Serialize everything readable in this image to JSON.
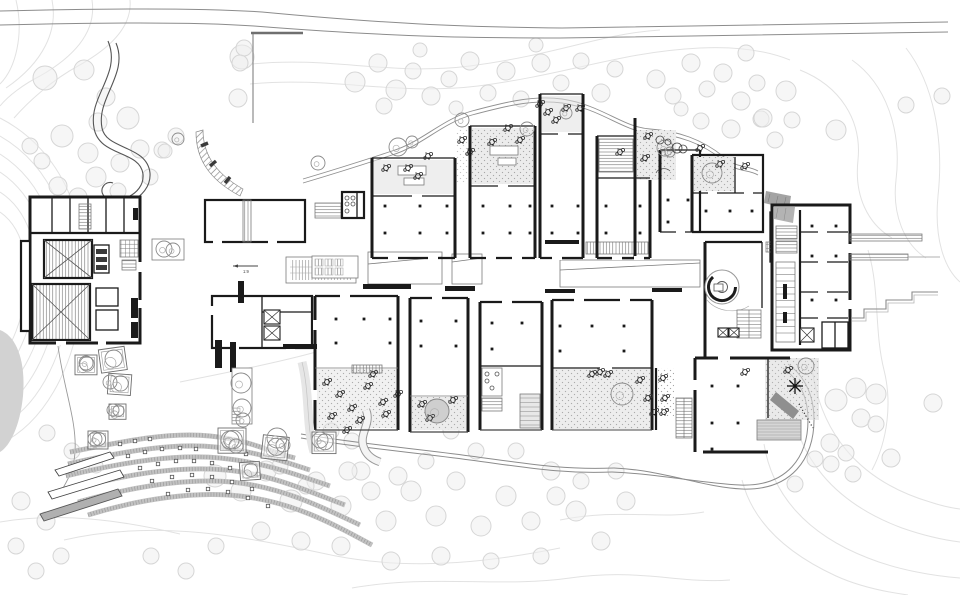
{
  "meta": {
    "drawing_type": "architectural site plan",
    "description": "Black-and-white campus site plan on a contoured, tree-covered hillside with curved terraced seating at lower left"
  },
  "palette": {
    "background": "#ffffff",
    "wall": "#1a1a1a",
    "wall_medium": "#4a4a4a",
    "outline_light": "#7a7a7a",
    "contour": "#e2e2e2",
    "tree_stroke": "#d6d6d6",
    "tree_fill": "#efefef",
    "paving_gray": "#e0e0e0",
    "stipple": "#9c9c9c",
    "terrace_band": "#c2c2c2",
    "terrace_tick": "#7d7d7d",
    "road": "#8c8c8c",
    "dark_gray_fill": "#9a9a9a",
    "hill_fill": "#d2d2d2"
  },
  "annotations": {
    "ramp_label": "1:9"
  },
  "site": {
    "hill_blob": "M0,330 C16,336 26,360 23,396 C20,426 10,446 0,452 Z",
    "contours": [
      "M0,118 C62,150 92,220 82,300 C74,372 42,424 0,444",
      "M0,136 C52,166 78,228 70,300 C62,364 34,410 0,426",
      "M0,154 C44,182 64,236 58,298 C52,352 26,396 0,410",
      "M0,172 C36,196 52,242 47,296 C42,342 20,382 0,394",
      "M0,192 C28,210 40,248 36,292 C32,330 14,366 0,376",
      "M0,212 C20,226 28,252 26,288 C24,318 10,350 0,358",
      "M16,0 C24,34 16,68 0,84",
      "M52,0 C58,30 44,62 6,88",
      "M92,0 C96,26 82,52 40,76 C24,84 8,96 0,106",
      "M130,0 C132,22 118,44 78,66 C52,80 28,102 14,118",
      "M252,64 C330,56 390,76 470,66 C560,54 600,34 660,30",
      "M250,84 C330,76 396,96 478,86 C570,74 620,52 700,48 C740,46 770,52 790,60",
      "M800,70 C840,86 862,120 858,160 C854,196 868,224 892,238",
      "M852,60 C886,84 902,130 896,180 C892,214 904,244 926,258",
      "M906,48 C934,84 944,140 938,196 C934,238 944,268 960,282",
      "M868,250 C880,290 874,330 884,370 C892,402 888,440 872,470",
      "M812,368 C820,430 856,480 930,502 C942,506 952,508 960,509",
      "M790,400 C798,456 832,502 902,528 C922,535 944,540 960,542",
      "M764,444 C772,494 806,534 868,558 C898,570 934,576 960,578",
      "M742,480 C752,520 784,552 836,576 C858,586 886,592 908,595",
      "M64,540 C160,518 250,538 336,556 C420,572 500,560 560,548",
      "M0,522 C60,512 120,520 180,534",
      "M352,588 C430,574 500,588 570,578 C640,568 680,584 730,580",
      "M560,520 C620,508 660,520 704,512",
      "M180,382 C230,372 280,362 316,352"
    ],
    "roads": [
      {
        "d": "M0,11 C120,8 205,8 262,12 C400,25 472,27 562,28 L948,22",
        "w": 1,
        "c": "#8c8c8c"
      },
      {
        "d": "M0,25 C118,22 198,22 254,26 C394,37 470,38 560,38 L948,32",
        "w": 1,
        "c": "#8c8c8c"
      },
      {
        "d": "M253,34 L253,123",
        "w": 1.2,
        "c": "#8c8c8c"
      },
      {
        "d": "M251,33 L303,33",
        "w": 2.4,
        "c": "#6f6f6f"
      },
      {
        "d": "M303,179 C340,168 362,161 392,151 C422,142 442,119 472,111 C502,103 532,95 562,99 C602,105 622,127 650,129 C678,131 702,139 724,157 C738,169 748,165 758,171",
        "w": 0.9,
        "c": "#909090"
      },
      {
        "d": "M303,183 C340,172 362,165 392,155 C422,146 442,123 472,115 C502,107 532,99 562,103 C602,109 622,131 650,133 C678,135 702,143 724,161 C738,173 748,169 758,175",
        "w": 0.9,
        "c": "#909090"
      },
      {
        "d": "M108,41 C122,74 88,96 94,128 C99,157 140,150 143,174 C145,196 114,206 104,196 C98,189 106,180 113,183",
        "w": 1.1,
        "c": "#555555"
      },
      {
        "d": "M116,43 C129,74 96,98 102,128 C106,150 147,145 150,173 C152,200 112,214 98,199",
        "w": 1.1,
        "c": "#555555"
      },
      {
        "d": "M301,434 C360,444 420,449 470,456 C530,464 562,470 614,468",
        "w": 1,
        "c": "#8c8c8c"
      },
      {
        "d": "M301,438 C360,448 420,453 470,460 C530,468 562,474 612,472",
        "w": 1,
        "c": "#8c8c8c"
      },
      {
        "d": "M614,468 C662,470 702,487 742,489 C792,491 814,458 814,420 C814,392 802,374 788,364",
        "w": 1,
        "c": "#8c8c8c"
      },
      {
        "d": "M612,472 C660,474 700,483 740,485 C788,487 808,456 808,420 C808,394 797,378 783,368",
        "w": 1,
        "c": "#8c8c8c"
      },
      {
        "d": "M58,346 C64,390 77,421 75,452 C74,471 66,483 60,493",
        "w": 0.9,
        "c": "#9a9a9a"
      }
    ],
    "terrace_bands": [
      "M70,452 C130,440 170,432 210,436 C250,440 270,452 295,458",
      "M68,464 C130,450 175,443 215,447 C255,451 285,462 310,470",
      "M66,476 C128,461 178,454 220,458 C262,462 295,474 330,486",
      "M72,489 C130,473 182,466 226,470 C270,474 305,490 345,505",
      "M78,502 C135,486 188,478 232,482 C280,487 318,505 360,525",
      "M88,515 C140,499 194,491 240,496 C292,502 330,522 372,545"
    ]
  },
  "vegetation": {
    "site_trees": [
      [
        45,
        78,
        12
      ],
      [
        84,
        70,
        10
      ],
      [
        128,
        118,
        11
      ],
      [
        98,
        122,
        9
      ],
      [
        62,
        136,
        11
      ],
      [
        88,
        153,
        10
      ],
      [
        120,
        163,
        9
      ],
      [
        96,
        177,
        10
      ],
      [
        58,
        186,
        9
      ],
      [
        78,
        197,
        9
      ],
      [
        118,
        191,
        8
      ],
      [
        140,
        149,
        9
      ],
      [
        42,
        161,
        8
      ],
      [
        150,
        177,
        8
      ],
      [
        30,
        146,
        8
      ],
      [
        106,
        97,
        9
      ],
      [
        242,
        57,
        12
      ],
      [
        244,
        48,
        8
      ],
      [
        240,
        63,
        8
      ],
      [
        238,
        98,
        9
      ],
      [
        176,
        136,
        8
      ],
      [
        162,
        150,
        8
      ],
      [
        165,
        151,
        7
      ],
      [
        355,
        82,
        10
      ],
      [
        378,
        63,
        9
      ],
      [
        396,
        90,
        10
      ],
      [
        413,
        71,
        8
      ],
      [
        431,
        96,
        9
      ],
      [
        449,
        79,
        8
      ],
      [
        470,
        61,
        9
      ],
      [
        488,
        93,
        8
      ],
      [
        506,
        71,
        9
      ],
      [
        521,
        99,
        8
      ],
      [
        541,
        63,
        9
      ],
      [
        561,
        83,
        8
      ],
      [
        581,
        61,
        8
      ],
      [
        601,
        93,
        9
      ],
      [
        615,
        69,
        8
      ],
      [
        384,
        106,
        8
      ],
      [
        420,
        50,
        7
      ],
      [
        456,
        108,
        7
      ],
      [
        536,
        45,
        7
      ],
      [
        656,
        79,
        9
      ],
      [
        673,
        96,
        8
      ],
      [
        691,
        63,
        9
      ],
      [
        707,
        89,
        8
      ],
      [
        723,
        73,
        9
      ],
      [
        741,
        101,
        9
      ],
      [
        757,
        83,
        8
      ],
      [
        701,
        121,
        8
      ],
      [
        731,
        129,
        9
      ],
      [
        761,
        119,
        8
      ],
      [
        681,
        109,
        7
      ],
      [
        746,
        53,
        8
      ],
      [
        775,
        140,
        8
      ],
      [
        792,
        120,
        8
      ],
      [
        786,
        91,
        10
      ],
      [
        763,
        118,
        9
      ],
      [
        836,
        130,
        10
      ],
      [
        906,
        105,
        8
      ],
      [
        942,
        96,
        8
      ],
      [
        836,
        400,
        11
      ],
      [
        856,
        388,
        10
      ],
      [
        876,
        394,
        10
      ],
      [
        933,
        403,
        9
      ],
      [
        861,
        418,
        9
      ],
      [
        876,
        424,
        8
      ],
      [
        830,
        443,
        9
      ],
      [
        846,
        453,
        8
      ],
      [
        815,
        459,
        8
      ],
      [
        831,
        464,
        8
      ],
      [
        891,
        458,
        9
      ],
      [
        795,
        484,
        8
      ],
      [
        853,
        474,
        8
      ],
      [
        215,
        476,
        11
      ],
      [
        241,
        491,
        10
      ],
      [
        266,
        471,
        10
      ],
      [
        291,
        501,
        11
      ],
      [
        316,
        481,
        9
      ],
      [
        341,
        506,
        10
      ],
      [
        361,
        471,
        9
      ],
      [
        386,
        521,
        10
      ],
      [
        411,
        491,
        10
      ],
      [
        436,
        516,
        10
      ],
      [
        456,
        481,
        9
      ],
      [
        481,
        526,
        10
      ],
      [
        506,
        496,
        10
      ],
      [
        531,
        521,
        9
      ],
      [
        551,
        471,
        9
      ],
      [
        576,
        511,
        10
      ],
      [
        601,
        541,
        9
      ],
      [
        626,
        501,
        9
      ],
      [
        341,
        546,
        9
      ],
      [
        391,
        561,
        9
      ],
      [
        441,
        556,
        9
      ],
      [
        491,
        561,
        8
      ],
      [
        301,
        541,
        9
      ],
      [
        261,
        531,
        9
      ],
      [
        541,
        556,
        8
      ],
      [
        581,
        481,
        8
      ],
      [
        616,
        471,
        8
      ],
      [
        352,
        441,
        8
      ],
      [
        331,
        431,
        8
      ],
      [
        451,
        431,
        8
      ],
      [
        476,
        451,
        8
      ],
      [
        398,
        476,
        9
      ],
      [
        426,
        461,
        8
      ],
      [
        516,
        451,
        8
      ],
      [
        556,
        496,
        9
      ],
      [
        348,
        471,
        9
      ],
      [
        371,
        491,
        9
      ],
      [
        21,
        501,
        9
      ],
      [
        46,
        521,
        9
      ],
      [
        16,
        546,
        8
      ],
      [
        61,
        556,
        8
      ],
      [
        36,
        571,
        8
      ],
      [
        151,
        556,
        8
      ],
      [
        186,
        571,
        8
      ],
      [
        216,
        546,
        8
      ],
      [
        47,
        433,
        8
      ],
      [
        72,
        451,
        8
      ],
      [
        96,
        466,
        7
      ],
      [
        280,
        466,
        8
      ],
      [
        306,
        486,
        8
      ]
    ],
    "scribble_trees": [
      [
        408,
        168
      ],
      [
        428,
        156
      ],
      [
        418,
        176
      ],
      [
        386,
        168
      ],
      [
        492,
        142
      ],
      [
        508,
        128
      ],
      [
        520,
        140
      ],
      [
        556,
        120
      ],
      [
        566,
        108
      ],
      [
        548,
        112
      ],
      [
        620,
        152
      ],
      [
        648,
        136
      ],
      [
        645,
        158
      ],
      [
        700,
        148
      ],
      [
        745,
        166
      ],
      [
        720,
        164
      ],
      [
        462,
        140
      ],
      [
        470,
        152
      ],
      [
        327,
        382
      ],
      [
        340,
        394
      ],
      [
        352,
        408
      ],
      [
        368,
        386
      ],
      [
        383,
        402
      ],
      [
        332,
        416
      ],
      [
        360,
        420
      ],
      [
        386,
        414
      ],
      [
        398,
        394
      ],
      [
        373,
        374
      ],
      [
        422,
        404
      ],
      [
        430,
        418
      ],
      [
        453,
        400
      ],
      [
        600,
        372
      ],
      [
        640,
        380
      ],
      [
        648,
        398
      ],
      [
        654,
        412
      ],
      [
        663,
        378
      ],
      [
        665,
        398
      ],
      [
        664,
        412
      ],
      [
        592,
        374
      ],
      [
        608,
        374
      ],
      [
        788,
        370
      ],
      [
        745,
        372
      ],
      [
        347,
        430
      ],
      [
        580,
        108
      ],
      [
        540,
        104
      ]
    ],
    "circle_trees": [
      [
        437,
        411,
        12
      ],
      [
        622,
        394,
        11
      ],
      [
        712,
        173,
        10
      ],
      [
        398,
        147,
        9
      ],
      [
        412,
        142,
        6
      ],
      [
        462,
        120,
        7
      ],
      [
        527,
        129,
        7
      ],
      [
        566,
        113,
        6
      ],
      [
        806,
        366,
        8
      ],
      [
        164,
        249,
        8
      ],
      [
        173,
        250,
        7
      ],
      [
        318,
        163,
        7
      ],
      [
        178,
        139,
        6
      ],
      [
        241,
        383,
        10
      ],
      [
        242,
        408,
        9
      ],
      [
        243,
        420,
        7
      ],
      [
        665,
        148,
        8
      ],
      [
        230,
        440,
        9
      ],
      [
        236,
        446,
        7
      ],
      [
        277,
        438,
        10
      ],
      [
        283,
        445,
        7
      ],
      [
        86,
        363,
        7
      ],
      [
        110,
        382,
        7
      ],
      [
        113,
        410,
        6
      ],
      [
        95,
        439,
        7
      ],
      [
        320,
        440,
        8
      ],
      [
        670,
        152,
        5
      ]
    ],
    "small_circles": [
      [
        660,
        140,
        4
      ],
      [
        668,
        142,
        3
      ],
      [
        677,
        148,
        5
      ],
      [
        683,
        149,
        4
      ]
    ],
    "palm": [
      795,
      386
    ]
  },
  "structures": {
    "columns": [
      [
        385,
        206
      ],
      [
        420,
        206
      ],
      [
        447,
        206
      ],
      [
        385,
        233
      ],
      [
        420,
        233
      ],
      [
        447,
        233
      ],
      [
        483,
        206
      ],
      [
        510,
        206
      ],
      [
        530,
        206
      ],
      [
        483,
        233
      ],
      [
        510,
        233
      ],
      [
        530,
        233
      ],
      [
        552,
        206
      ],
      [
        578,
        206
      ],
      [
        552,
        233
      ],
      [
        578,
        233
      ],
      [
        606,
        206
      ],
      [
        640,
        206
      ],
      [
        606,
        233
      ],
      [
        640,
        233
      ],
      [
        668,
        200
      ],
      [
        688,
        200
      ],
      [
        668,
        222
      ],
      [
        706,
        211
      ],
      [
        730,
        211
      ],
      [
        752,
        211
      ],
      [
        336,
        319
      ],
      [
        364,
        319
      ],
      [
        390,
        319
      ],
      [
        336,
        343
      ],
      [
        390,
        343
      ],
      [
        421,
        321
      ],
      [
        456,
        321
      ],
      [
        421,
        346
      ],
      [
        456,
        346
      ],
      [
        492,
        323
      ],
      [
        522,
        323
      ],
      [
        492,
        349
      ],
      [
        560,
        326
      ],
      [
        592,
        326
      ],
      [
        624,
        326
      ],
      [
        560,
        351
      ],
      [
        624,
        351
      ],
      [
        712,
        386
      ],
      [
        738,
        386
      ],
      [
        712,
        423
      ],
      [
        738,
        423
      ],
      [
        712,
        449
      ],
      [
        812,
        226
      ],
      [
        836,
        226
      ],
      [
        812,
        256
      ],
      [
        836,
        256
      ],
      [
        812,
        300
      ],
      [
        836,
        300
      ]
    ],
    "elevator_boxes": [
      [
        264,
        310,
        16,
        14
      ],
      [
        264,
        326,
        16,
        14
      ],
      [
        800,
        328,
        14,
        14
      ],
      [
        718,
        328,
        10,
        9
      ],
      [
        729,
        328,
        10,
        9
      ]
    ],
    "planters": [
      [
        75,
        355,
        22,
        0
      ],
      [
        100,
        348,
        26,
        -8
      ],
      [
        108,
        374,
        23,
        4
      ],
      [
        109,
        404,
        17,
        0
      ],
      [
        88,
        431,
        20,
        0
      ],
      [
        218,
        428,
        28,
        0
      ],
      [
        262,
        436,
        26,
        6
      ],
      [
        312,
        432,
        24,
        0
      ],
      [
        240,
        462,
        20,
        -4
      ]
    ],
    "terrace_squares": [
      [
        120,
        444
      ],
      [
        135,
        441
      ],
      [
        150,
        439
      ],
      [
        128,
        456
      ],
      [
        145,
        452
      ],
      [
        162,
        449
      ],
      [
        180,
        448
      ],
      [
        196,
        449
      ],
      [
        140,
        468
      ],
      [
        158,
        464
      ],
      [
        176,
        461
      ],
      [
        194,
        461
      ],
      [
        212,
        463
      ],
      [
        230,
        468
      ],
      [
        152,
        481
      ],
      [
        172,
        477
      ],
      [
        192,
        475
      ],
      [
        212,
        477
      ],
      [
        232,
        482
      ],
      [
        252,
        489
      ],
      [
        168,
        494
      ],
      [
        188,
        490
      ],
      [
        208,
        489
      ],
      [
        228,
        492
      ],
      [
        248,
        498
      ],
      [
        268,
        506
      ],
      [
        258,
        474
      ],
      [
        246,
        454
      ]
    ]
  }
}
